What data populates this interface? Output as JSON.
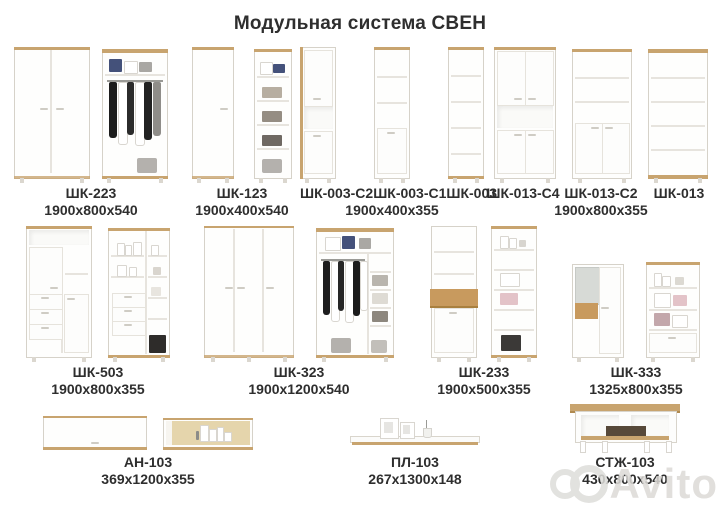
{
  "title": "Модульная система СВЕН",
  "watermark": "Avito",
  "colors": {
    "wood": "#c8a46f",
    "accent_wood": "#c89a5e",
    "text": "#2e2e2e",
    "watermark_gray": "#dcdad7"
  },
  "groups": {
    "g223": {
      "code": "ШК-223",
      "dims": "1900x800x540"
    },
    "g123": {
      "code": "ШК-123",
      "dims": "1900x400x540"
    },
    "g003": {
      "codes": [
        "ШК-003-С2",
        "ШК-003-С1",
        "ШК-003"
      ],
      "dims": "1900x400x355"
    },
    "g013": {
      "codes": [
        "ШК-013-С4",
        "ШК-013-С2",
        "ШК-013"
      ],
      "dims": "1900x800x355"
    },
    "g503": {
      "code": "ШК-503",
      "dims": "1900x800x355"
    },
    "g323": {
      "code": "ШК-323",
      "dims": "1900x1200x540"
    },
    "g233": {
      "code": "ШК-233",
      "dims": "1900x500x355"
    },
    "g333": {
      "code": "ШК-333",
      "dims": "1325x800x355"
    },
    "gan103": {
      "code": "АН-103",
      "dims": "369x1200x355"
    },
    "gpl103": {
      "code": "ПЛ-103",
      "dims": "267x1300x148"
    },
    "gstzh103": {
      "code": "СТЖ-103",
      "dims": "430x800x540"
    }
  }
}
